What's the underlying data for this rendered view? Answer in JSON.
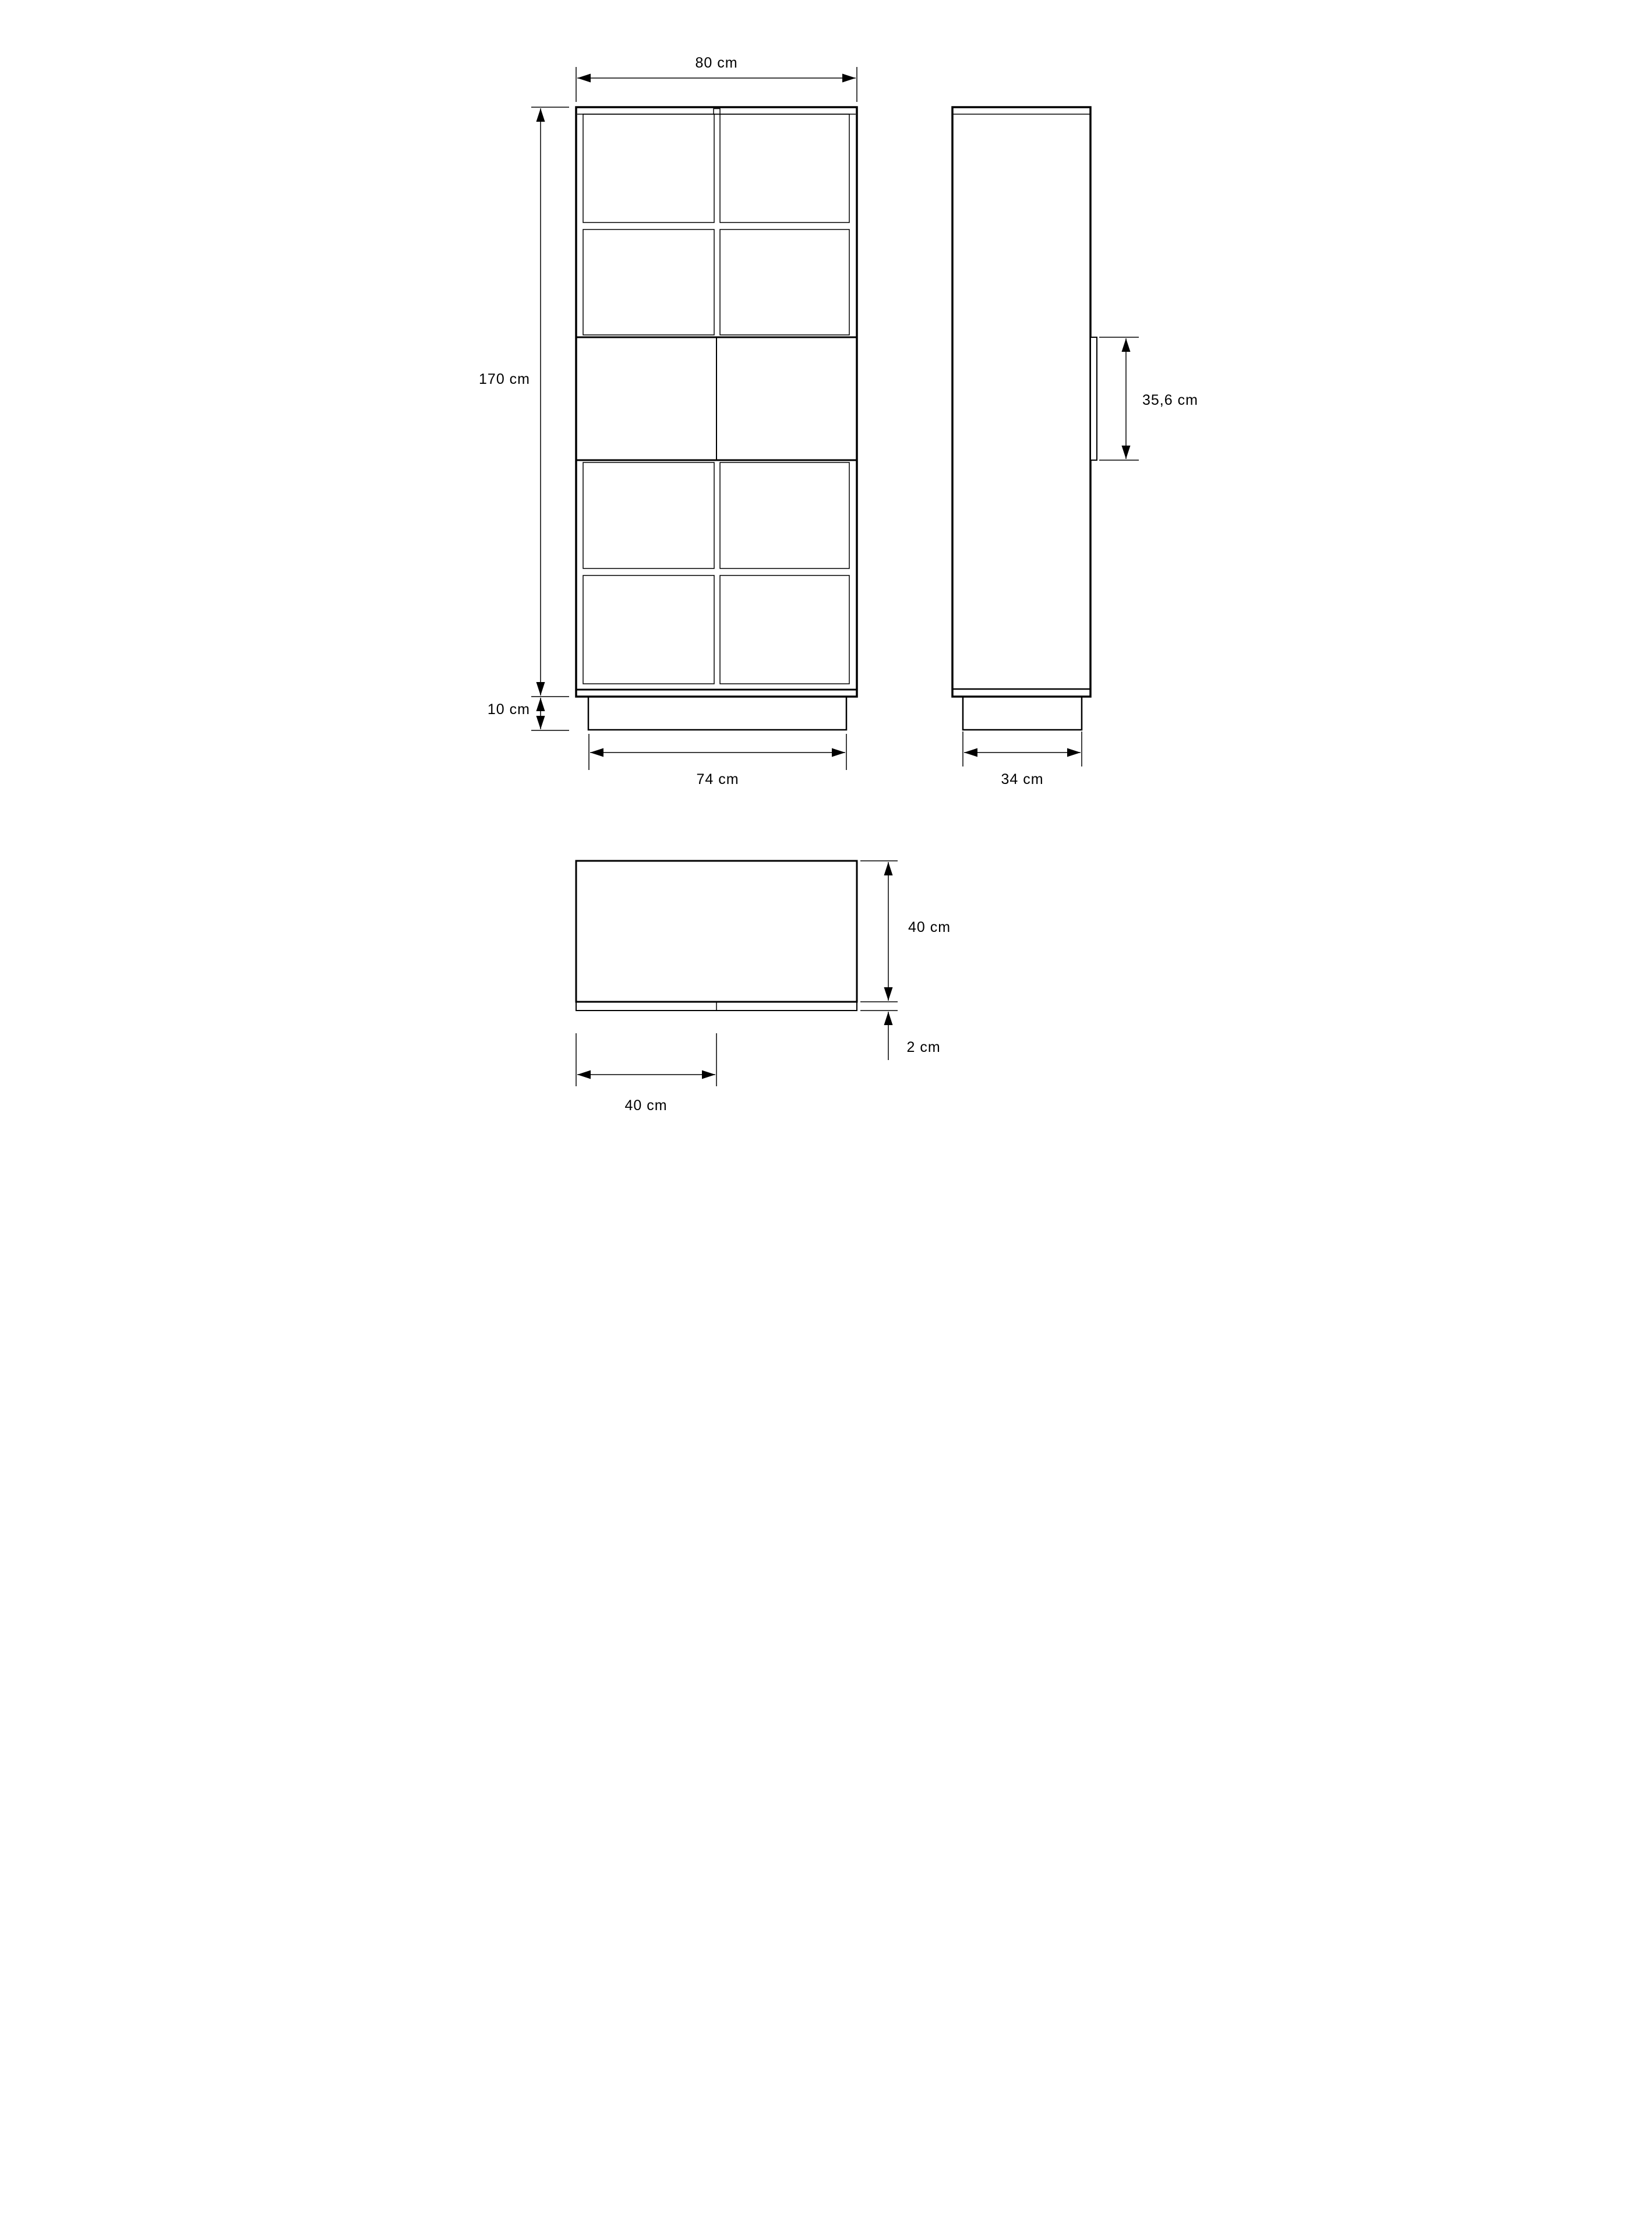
{
  "drawing": {
    "background": "#ffffff",
    "line_color": "#000000",
    "views": {
      "front": {
        "name": "front-elevation",
        "dimensions": {
          "width": "80 cm",
          "height": "170 cm",
          "plinth_height": "10 cm",
          "plinth_width": "74 cm"
        }
      },
      "side": {
        "name": "side-elevation",
        "dimensions": {
          "door_panel_height": "35,6 cm",
          "plinth_depth": "34 cm"
        }
      },
      "top": {
        "name": "top-plan",
        "dimensions": {
          "depth": "40 cm",
          "door_thickness": "2 cm",
          "door_width": "40 cm"
        }
      }
    }
  }
}
